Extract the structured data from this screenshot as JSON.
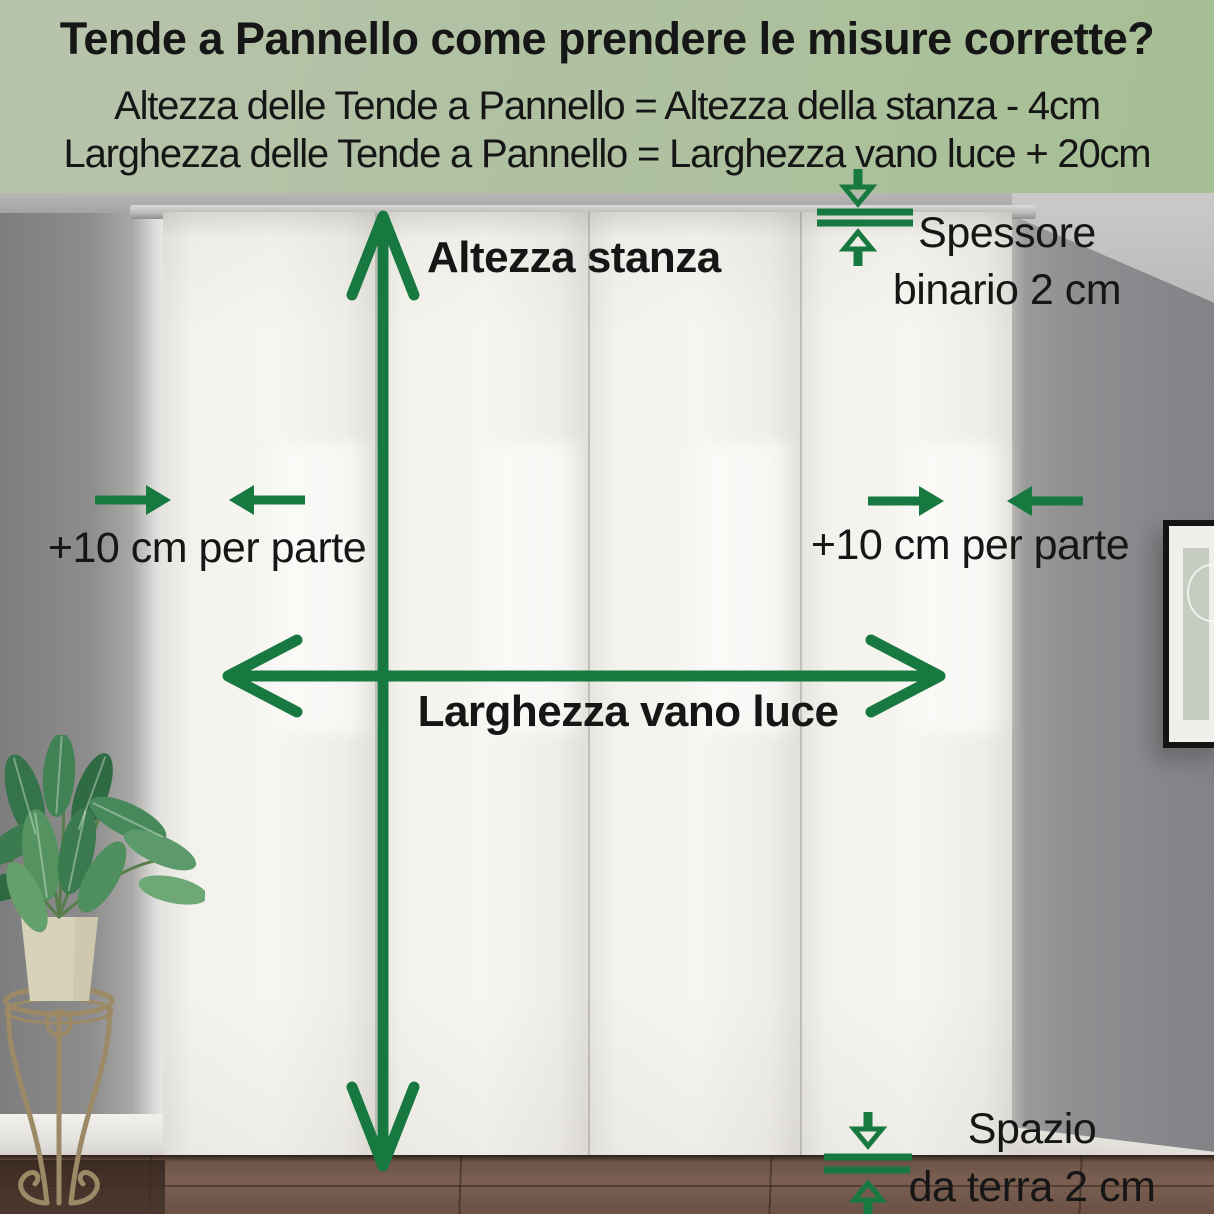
{
  "header": {
    "title": "Tende a Pannello come prendere le misure corrette?",
    "formula_height": "Altezza delle Tende a Pannello = Altezza della stanza - 4cm",
    "formula_width": "Larghezza delle Tende a Pannello = Larghezza vano luce + 20cm"
  },
  "annotations": {
    "room_height": "Altezza stanza",
    "opening_width": "Larghezza vano luce",
    "side_left": "+10 cm per parte",
    "side_right": "+10 cm per parte",
    "rail_line1": "Spessore",
    "rail_line2": "binario 2 cm",
    "gap_line1": "Spazio",
    "gap_line2": "da terra 2 cm"
  },
  "icons": {
    "vertical_measure": "double-headed-vertical-arrow",
    "horizontal_measure": "double-headed-horizontal-arrow",
    "side_allowance_left": "two-inward-arrows",
    "side_allowance_right": "two-inward-arrows",
    "rail_thickness": "arrows-to-double-lines",
    "floor_gap": "arrows-to-double-lines"
  },
  "colors": {
    "accent_green": "#17793f",
    "ink": "#161616",
    "header_bg_start": "#b8c3ac",
    "header_bg_end": "#a6bf94"
  }
}
